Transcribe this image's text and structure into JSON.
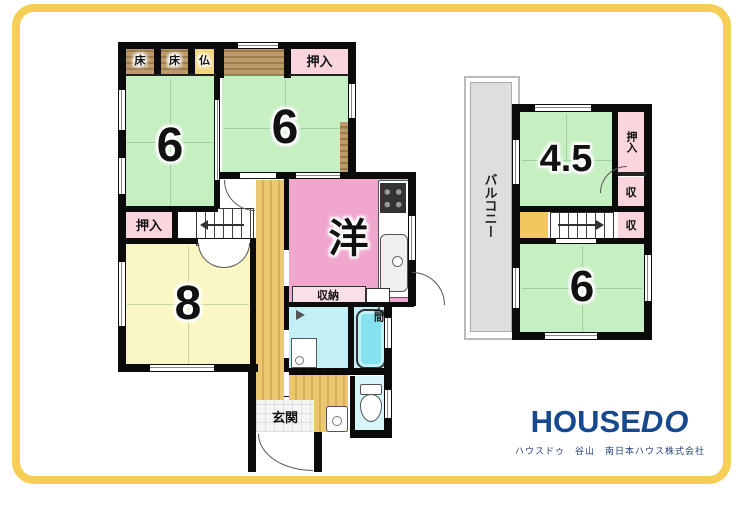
{
  "floor1": {
    "toko1": "床",
    "toko2": "床",
    "butsudan": "仏",
    "oshiire_top": "押入",
    "room6_left": "6",
    "room6_right": "6",
    "oshiire_left": "押入",
    "room8": "8",
    "western": "洋",
    "shunou": "収納",
    "doma": "土間",
    "genkan": "玄関"
  },
  "floor2": {
    "balcony": "バルコニー",
    "room45": "4.5",
    "oshiire": "押入",
    "shu_upper": "収",
    "shu_lower": "収",
    "room6": "6"
  },
  "logo": {
    "house": "HOUSE",
    "do": "DO",
    "subtitle": "ハウスドゥ　谷山　南日本ハウス株式会社"
  },
  "colors": {
    "frame": "#F6CE55",
    "tatami_green": "#C6EFC2",
    "room_yellow": "#FBF7C5",
    "western_pink": "#F1A6CE",
    "closet_pink": "#FBD5DD",
    "butsudan_gold": "#F0D77E",
    "wood_brown": "#B3905F",
    "hall_tan": "#E9C36B",
    "bath_cyan": "#C5EFF6",
    "tub_cyan": "#85E2EE",
    "toilet_cyan": "#D8F5F9",
    "balcony_gray": "#DEDEDE",
    "logo_blue": "#17498F",
    "wall_black": "#0B0B0B"
  }
}
